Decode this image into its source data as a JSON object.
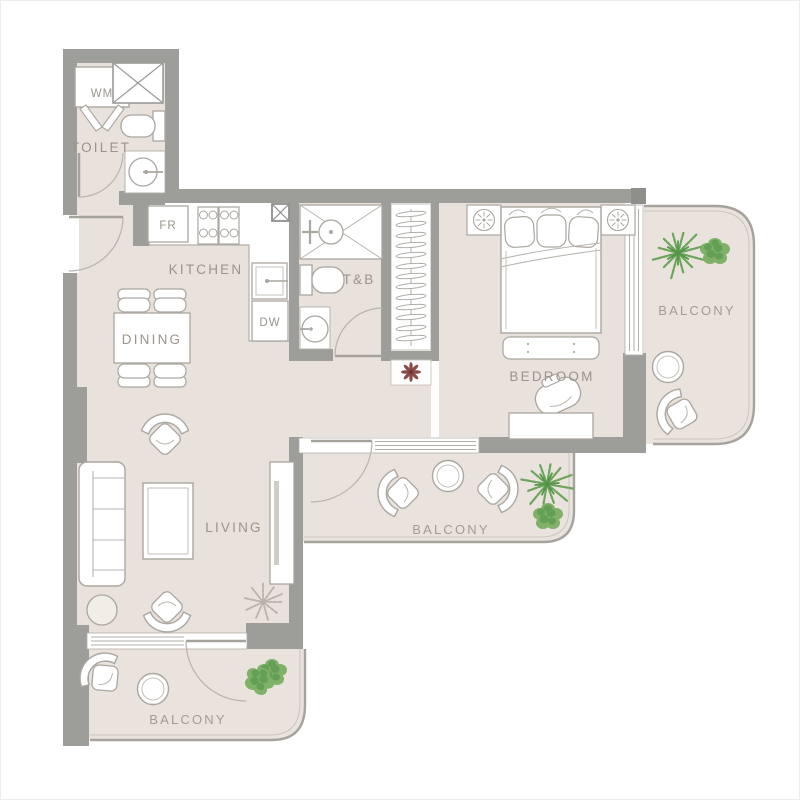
{
  "floorplan": {
    "rooms": {
      "toilet": "TOILET",
      "kitchen": "KITCHEN",
      "dining": "DINING",
      "living": "LIVING",
      "bathroom": "T&B",
      "bedroom": "BEDROOM",
      "balcony_right": "BALCONY",
      "balcony_middle": "BALCONY",
      "balcony_bottom": "BALCONY"
    },
    "appliances": {
      "washing_machine": "WM",
      "fridge": "FR",
      "dishwasher": "DW"
    },
    "colors": {
      "background": "#ffffff",
      "floor": "#e9e1db",
      "balcony_floor": "#eae3dd",
      "wall": "#9d9d99",
      "furniture_outline": "#aaa6a0",
      "label_text": "#9a948d",
      "plant_green": "#6ba55b",
      "plant_green_light": "#7fb169",
      "plant_red": "#8c4a47",
      "plant_gray": "#b7b3ab"
    }
  }
}
